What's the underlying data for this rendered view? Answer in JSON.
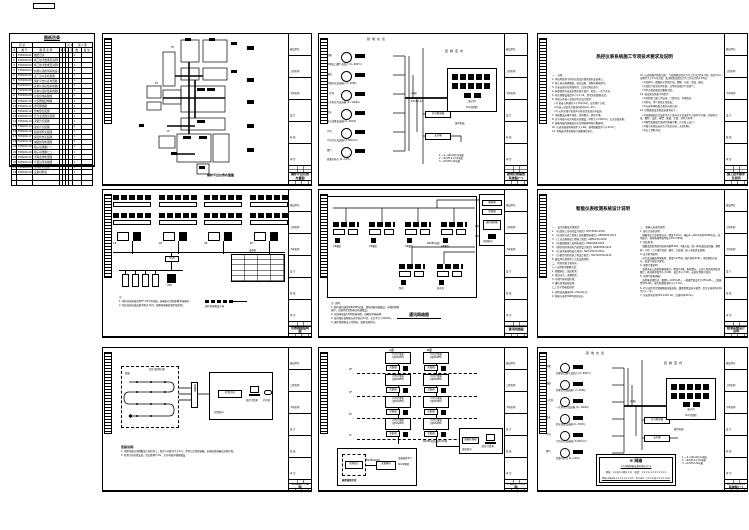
{
  "page": {
    "bg": "#ffffff",
    "ink": "#000000"
  },
  "titleblock": {
    "sections": [
      "建设单位",
      "工程名称",
      "子项名称",
      "设 计",
      "校 核",
      "审 定"
    ]
  },
  "catalog": {
    "corner_tag": "目 录",
    "title": "图纸目录",
    "meta_left": "共 1 册",
    "meta_right": "第 1 册",
    "headers": [
      "序",
      "图  号",
      "图 纸 名 称",
      "幅",
      "版",
      "页",
      "张",
      "数",
      "备 注"
    ],
    "rows": [
      {
        "no": "1",
        "code": "F2816K-01",
        "name": "图纸目录",
        "qty": "1"
      },
      {
        "no": "2",
        "code": "F2816K-02",
        "name": "施工技术要求及说明(一)",
        "qty": "1"
      },
      {
        "no": "3",
        "code": "F2816K-03",
        "name": "施工技术要求及说明(二)",
        "qty": "1"
      },
      {
        "no": "4",
        "code": "F2816K-04",
        "name": "智能仪表检测系统设计说明",
        "qty": "1"
      },
      {
        "no": "5",
        "code": "F2816K-05",
        "name": "主厂房仪表布置图",
        "qty": "1"
      },
      {
        "no": "6",
        "code": "F2816K-06",
        "name": "锅炉平台仪表布置图",
        "qty": "1"
      },
      {
        "no": "7",
        "code": "F2816K-07",
        "name": "就地仪表接线系统图(一)",
        "qty": "1"
      },
      {
        "no": "8",
        "code": "F2816K-08",
        "name": "就地仪表接线系统图(二)",
        "qty": "1"
      },
      {
        "no": "9",
        "code": "F2816K-09",
        "name": "仪表供电系统图",
        "qty": "1"
      },
      {
        "no": "10",
        "code": "F2816K-10",
        "name": "仪表网络结构图",
        "qty": "1"
      },
      {
        "no": "11",
        "code": "F2816K-11",
        "name": "通讯网络图",
        "qty": "1"
      },
      {
        "no": "12",
        "code": "F2816K-12",
        "name": "热电阻安装图",
        "qty": "1"
      },
      {
        "no": "13",
        "code": "F2816K-13",
        "name": "压力变送器安装图",
        "qty": "1"
      },
      {
        "no": "14",
        "code": "F2816K-14",
        "name": "流量计安装图",
        "qty": "1"
      },
      {
        "no": "15",
        "code": "F2816K-15",
        "name": "液位计安装图",
        "qty": "1"
      },
      {
        "no": "16",
        "code": "F2816K-16",
        "name": "取源部件安装图",
        "qty": "1"
      },
      {
        "no": "17",
        "code": "F2816K-17",
        "name": "保温伴热安装图",
        "qty": "1"
      },
      {
        "no": "18",
        "code": "F2816K-18",
        "name": "电缆桥架布置图",
        "qty": "1"
      },
      {
        "no": "19",
        "code": "F2816K-19",
        "name": "端子接线图(一)",
        "qty": "1"
      },
      {
        "no": "20",
        "code": "F2816K-20",
        "name": "端子接线图(二)",
        "qty": "1"
      },
      {
        "no": "21",
        "code": "F2816K-21",
        "name": "泄漏监测布置图",
        "qty": "1"
      },
      {
        "no": "22",
        "code": "F2816K-22",
        "name": "计量远传系统图",
        "qty": "1"
      },
      {
        "no": "23",
        "code": "F2816K-23",
        "name": "控制柜布置图",
        "qty": "1"
      },
      {
        "no": "24",
        "code": "F2816K-24",
        "name": "设备材料表",
        "qty": "1"
      },
      {
        "no": "",
        "code": "",
        "name": "",
        "qty": ""
      },
      {
        "no": "",
        "code": "",
        "name": "",
        "qty": ""
      }
    ]
  },
  "b1": {
    "tb_title": "锅炉平台仪表布置图",
    "caption": "锅炉平台仪表布置图",
    "tag1": "TE",
    "tag2": "PT",
    "tag3": "LT"
  },
  "loop": {
    "zone_left": "就地仪表",
    "zone_right": "控制室内",
    "instruments": [
      {
        "loc": "炉膛",
        "caption": "炉膛出口烟气温度计 (0~600℃)"
      },
      {
        "loc": "烟道",
        "caption": "炉膛负压变送器 (-2~2kPa)"
      },
      {
        "loc": "一次风",
        "caption": "一次风压力变送器 (0~10kPa)"
      },
      {
        "loc": "给水",
        "caption": "给水流量变送器 (0~50t/h)"
      },
      {
        "loc": "汽包",
        "caption": "汽包水位变送器 (±300mm)"
      },
      {
        "loc": "烟气",
        "caption": "氧量分析仪 (0~10%)"
      }
    ],
    "cable1": "(2根)",
    "cable2": "KVVP2-22",
    "isolator": "信号隔离器",
    "barrier": "安全栅",
    "spare": "备用电缆",
    "cabinet": "端子排",
    "cabinet_sub": "PLC控制柜",
    "legend": [
      "1 —4~20mA信号电缆",
      "2 —RVVP-2×1.0电缆",
      "3 —KVVP2-22电缆"
    ]
  },
  "c1": {
    "tb_title": "就地仪表接线系统图(一)"
  },
  "d1": {
    "tb_title": "施工技术要求及说明",
    "title": "热控仪表系统施工专项技术要求及说明",
    "col1": [
      "一、 总则",
      "1. 本说明适用于热控仪表及控制系统的安装施工。",
      "2. 施工前应熟悉图纸，核对设备、材料的规格型号。",
      "3. 仪表安装应在管道吹扫、试压合格后进行。",
      "4. 取源部件的安装位置应便于维护、检修，一次门齐全。",
      "5. 导压管敷设坡度不小于1:12，拐弯处应圆滑过渡。",
      "6. 测温元件插入深度应符合设计要求：",
      "　(1) 管道公称通径小于76mm时，应采用扩大管；",
      "　(2) 插入深度宜为管道内径的1/2~2/3；",
      "　(3) 元件应迎介质流向与管道呈逆流方向安装。",
      "7. 电缆敷设应横平竖直，排列整齐，固定牢靠。",
      "8. 信号电缆与动力电缆分层敷设，净距大于150mm，交叉处成直角。",
      "9. 屏蔽电缆的屏蔽层应在控制室侧单端可靠接地。",
      "10. 仪表系统接地电阻不大于4Ω，接地线截面不小于4mm²。",
      "11. 本图未尽事宜按现行国家规范执行。"
    ],
    "col2": [
      "12. 仪表管路严密性试验：气动管路试验压力为工作压力的1.5倍，保压5min压降不大于1%为合格；液压管路试验压力为工作压力的1.25倍。",
      "　(1)试验时，缓慢升压至规定值，观察、记录、复核、确认；",
      "　(2)试验介质宜采用干燥、洁净的压缩空气或氮气；",
      "　(3)不合格处理后应重新试验。",
      "13. 调试前应具备下列条件：",
      "　(1)控制室土建工作结束，门窗齐全，环境清洁；",
      "　(2)供电、供气系统正常投运；",
      "　(3)仪表单体校验合格并出具记录。",
      "14. 回路联校及系统投运要求如下：",
      "　(1)回路联校综合误差不大于各环节允许误差平方和的平方根，并做好记录：量程、误差、报警、联锁、定值、动作方向等；",
      "　(2)报警及联锁定值动作准确可靠，方可投入运行；",
      "　(3)调节系统投运应先手动后自动，无扰切换。",
      "　(4)交工资料齐全。"
    ]
  },
  "b2": {
    "tb_title": "仪表网络结构图",
    "groups": [
      "1#",
      "2#",
      "3#",
      "4#"
    ],
    "hub": "HUB",
    "ups": "UPS",
    "table_title": "设备表",
    "legend_caption": "通讯电缆敷设示意",
    "notes": [
      "注:",
      "1. 现场总线电缆采用FF-H1专用电缆，屏蔽层在控制室侧单端接地。",
      "2. 每段总线挂接设备不超过12台，线路两端配终端匹配电阻。"
    ]
  },
  "c2": {
    "tb_title": "通讯网络图",
    "caption": "通讯网络图",
    "clusters_top": [
      "1#罐区",
      "2#罐区",
      "3#罐区",
      "4#罐区"
    ],
    "clusters_mid": [
      "泵房",
      "装车区"
    ],
    "panel_box1": "隔离栅",
    "panel_box2": "转换器",
    "panel_center": "通讯管理机",
    "panel_room": "控制室内",
    "bus_label": "RS485总线",
    "notes": [
      "注: 说明",
      "1. 图中通讯线采用RS485总线、双绞屏蔽电缆敷设，穿镀锌钢管保护，由现场至控制室沿桥架敷设。",
      "2. 总线两端设120Ω终端电阻，屏蔽层单端接地。",
      "3. 每回路挂接智能仪表不超过31台，总长不大于1200m。",
      "4. 通讯管理机设于控制室，双路电源供电。"
    ]
  },
  "d2": {
    "tb_title": "检测系统设计说明",
    "title": "智能仪表检测系统设计说明",
    "col1": [
      "一、 设计依据及采用规范：",
      "1. 《石油化工自动化设计规范》SH/T3005-2016",
      "2. 《自动化仪表工程施工及质量验收规范》GB50093-2013",
      "3. 《工业金属管道工程施工规范》GB50235-2010",
      "4. 《电缆线路施工及验收规范》GB50168-2018",
      "5. 《爆炸危险环境电力装置设计规范》GB50058-2014",
      "6. 《仪表系统接地设计规范》HG/T20513-2014",
      "7. 《分散型控制系统工程设计规定》HG/T20700-2014",
      "8. 建设单位提供的工艺及设备资料。",
      "二、 检测系统主要内容：",
      "(一) 过程检测参数包括：",
      "1. 储罐液位、温度检测；",
      "2. 管道压力、流量检测；",
      "3. 可燃气体浓度检测；",
      "4. 罐区泄漏连续监测。",
      "(二) 信号传输及处理：",
      "1. 现场变送器采用4~20mA信号；",
      "2. 智能仪表带HART通讯协议。"
    ],
    "col2": [
      "三、 智能仪表选型说明：",
      "1. 液位计选型说明：",
      "　储罐液位计选用雷达式，精度±3mm，输出4~20mA并带HART协议，就地显示，现场防爆等级不低于Exd IIBT4。",
      "2. 温度检测：",
      "　储罐温度检测选用铂热电阻Pt100，A级分度，配一体化温度变送器，量程按一介质（工艺操作温度）确定，分度线、插入深度见安装图。",
      "3. 压力检测说明：",
      "　压力变送器选用智能型，精度0.075级，膜片材质316L，带就地指示表头，高温介质加冷凝弯。",
      "4. 流量计量说明：",
      "　装置进出口选用质量流量计，精度0.2级，配积算仪；公用工程选用涡街流量计，表前直管段不小于10D、表后不小于5D，安装位置便于维护。",
      "5. 可燃气体探测器：",
      "　选用催化燃烧式，量程0~100%LEL，一级报警值设定为25%LEL，二级报警50%LEL，探头距释放源不大于7.5m。",
      "6. 信号远传至控制室数据采集系统，重要参数设声光报警，历史记录保存时间不少于一年。",
      "7. 仪表供电采用UPS 220V AC，后备时间30min。"
    ]
  },
  "b3": {
    "tb_title": "泄漏监测布置图",
    "zone": "库区(监测区域)",
    "start": "始端",
    "jbox": "接线箱",
    "device": "检测主机",
    "pc": "监控计算机",
    "printer": "打印机",
    "room": "控制室内",
    "notes_title": "安装说明:",
    "notes": [
      "1. 测漏电缆沿沟槽敷设于防护层上，固定卡间距不大于1m，不得与尖锐物接触，末端接终端器后加保护盒。",
      "2. 检测主机挂墙安装，底边距地1.5m，信号电缆穿钢管敷设。"
    ]
  },
  "c3": {
    "tb_title": "计量远传系统图",
    "col_labels": [
      "A座",
      "B座"
    ],
    "floors": [
      "4F",
      "3F",
      "2F",
      "1F"
    ],
    "grp_line1": "户用计量表",
    "grp_line2": "(带RS485)",
    "grp_chip": "采集器",
    "bus_label": "RS485总线  穿SC20管",
    "pc_module": "数据转换器",
    "pc_label": "监控计算机",
    "pc_room": "值班室内",
    "inset_title": "典型接线示意",
    "inset_dash": "就地表计",
    "inset_line": "RS485(A/B)",
    "inset_box": "采集模块",
    "inset_note1": "金属软管2m",
    "inset_note2": "SC20钢管"
  },
  "d3": {
    "tb_title": "就地仪表接线系统图(二)",
    "stamp_logo": "≡ 网络",
    "stamp_name": "××科技网络设备有限公司 ⑤",
    "stamp_line1": "地址：××市××路××号　电话：××××-××××××××",
    "stamp_line2": "http://www.××××××.com　E-mail：××××@××××.com"
  }
}
